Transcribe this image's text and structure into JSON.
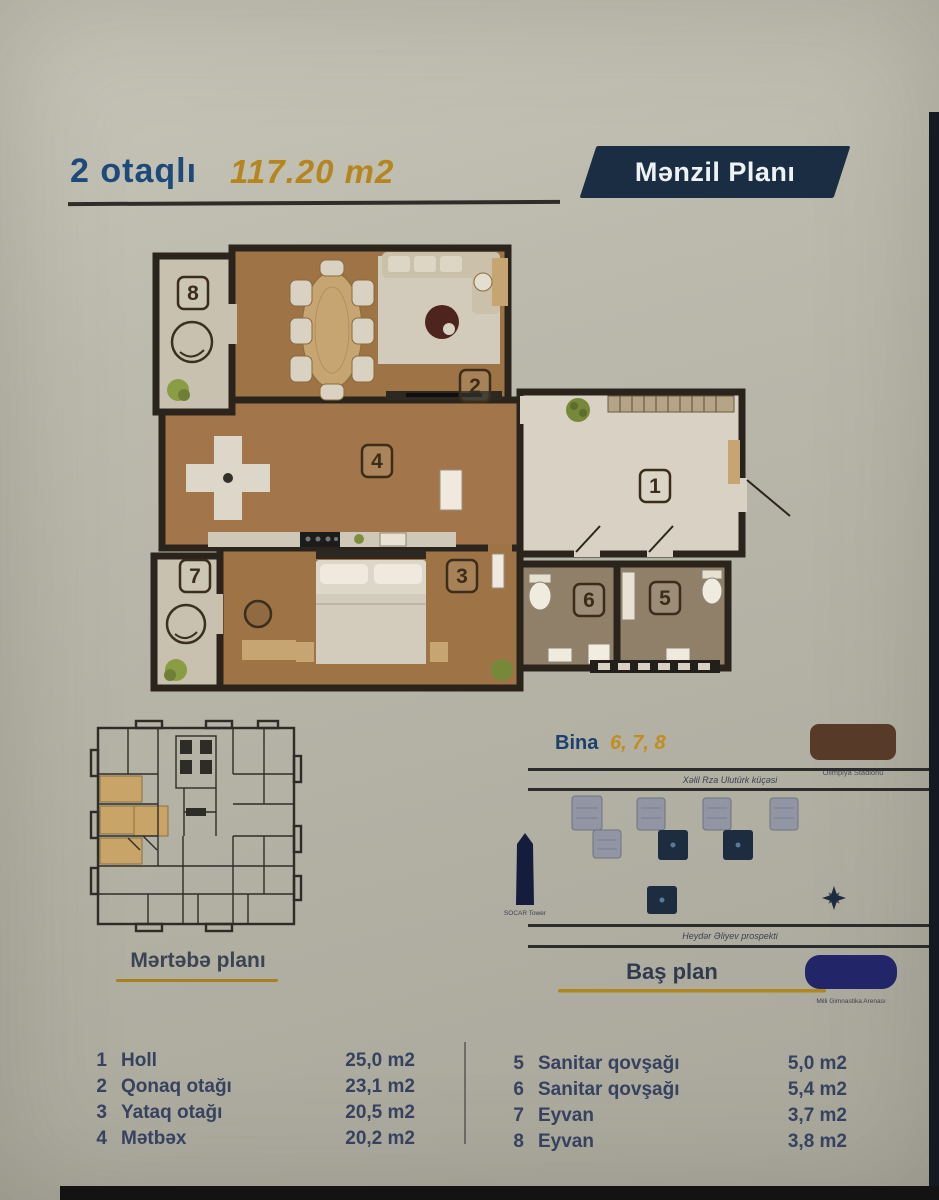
{
  "header": {
    "rooms_label": "2 otaqlı",
    "area_label": "117.20 m2",
    "badge": "Mənzil Planı"
  },
  "plan": {
    "room_labels": [
      "1",
      "2",
      "3",
      "4",
      "5",
      "6",
      "7",
      "8"
    ]
  },
  "martaba": {
    "title": "Mərtəbə planı"
  },
  "bas": {
    "title": "Baş plan",
    "bina_label": "Bina",
    "bina_numbers": "6, 7, 8",
    "street_top": "Xəlil Rza Ulutürk küçəsi",
    "street_bottom": "Heydər Əliyev prospekti",
    "stadium_caption": "Olimpiya Stadionu",
    "tower_caption": "SOCAR Tower",
    "arena_caption": "Milli Gimnastika Arenası"
  },
  "legend": {
    "left": [
      {
        "num": "1",
        "name": "Holl",
        "area": "25,0 m2"
      },
      {
        "num": "2",
        "name": "Qonaq otağı",
        "area": "23,1 m2"
      },
      {
        "num": "3",
        "name": "Yataq otağı",
        "area": "20,5 m2"
      },
      {
        "num": "4",
        "name": "Mətbəx",
        "area": "20,2 m2"
      }
    ],
    "right": [
      {
        "num": "5",
        "name": "Sanitar qovşağı",
        "area": "5,0 m2"
      },
      {
        "num": "6",
        "name": "Sanitar qovşağı",
        "area": "5,4 m2"
      },
      {
        "num": "7",
        "name": "Eyvan",
        "area": "3,7 m2"
      },
      {
        "num": "8",
        "name": "Eyvan",
        "area": "3,8 m2"
      }
    ]
  },
  "colors": {
    "navy_badge": "#1b2d42",
    "title_blue": "#1d4a7a",
    "gold": "#b5851e",
    "wall": "#2b241c",
    "floor_brown": "#9e7447",
    "hall_floor": "#d9d2c4"
  }
}
